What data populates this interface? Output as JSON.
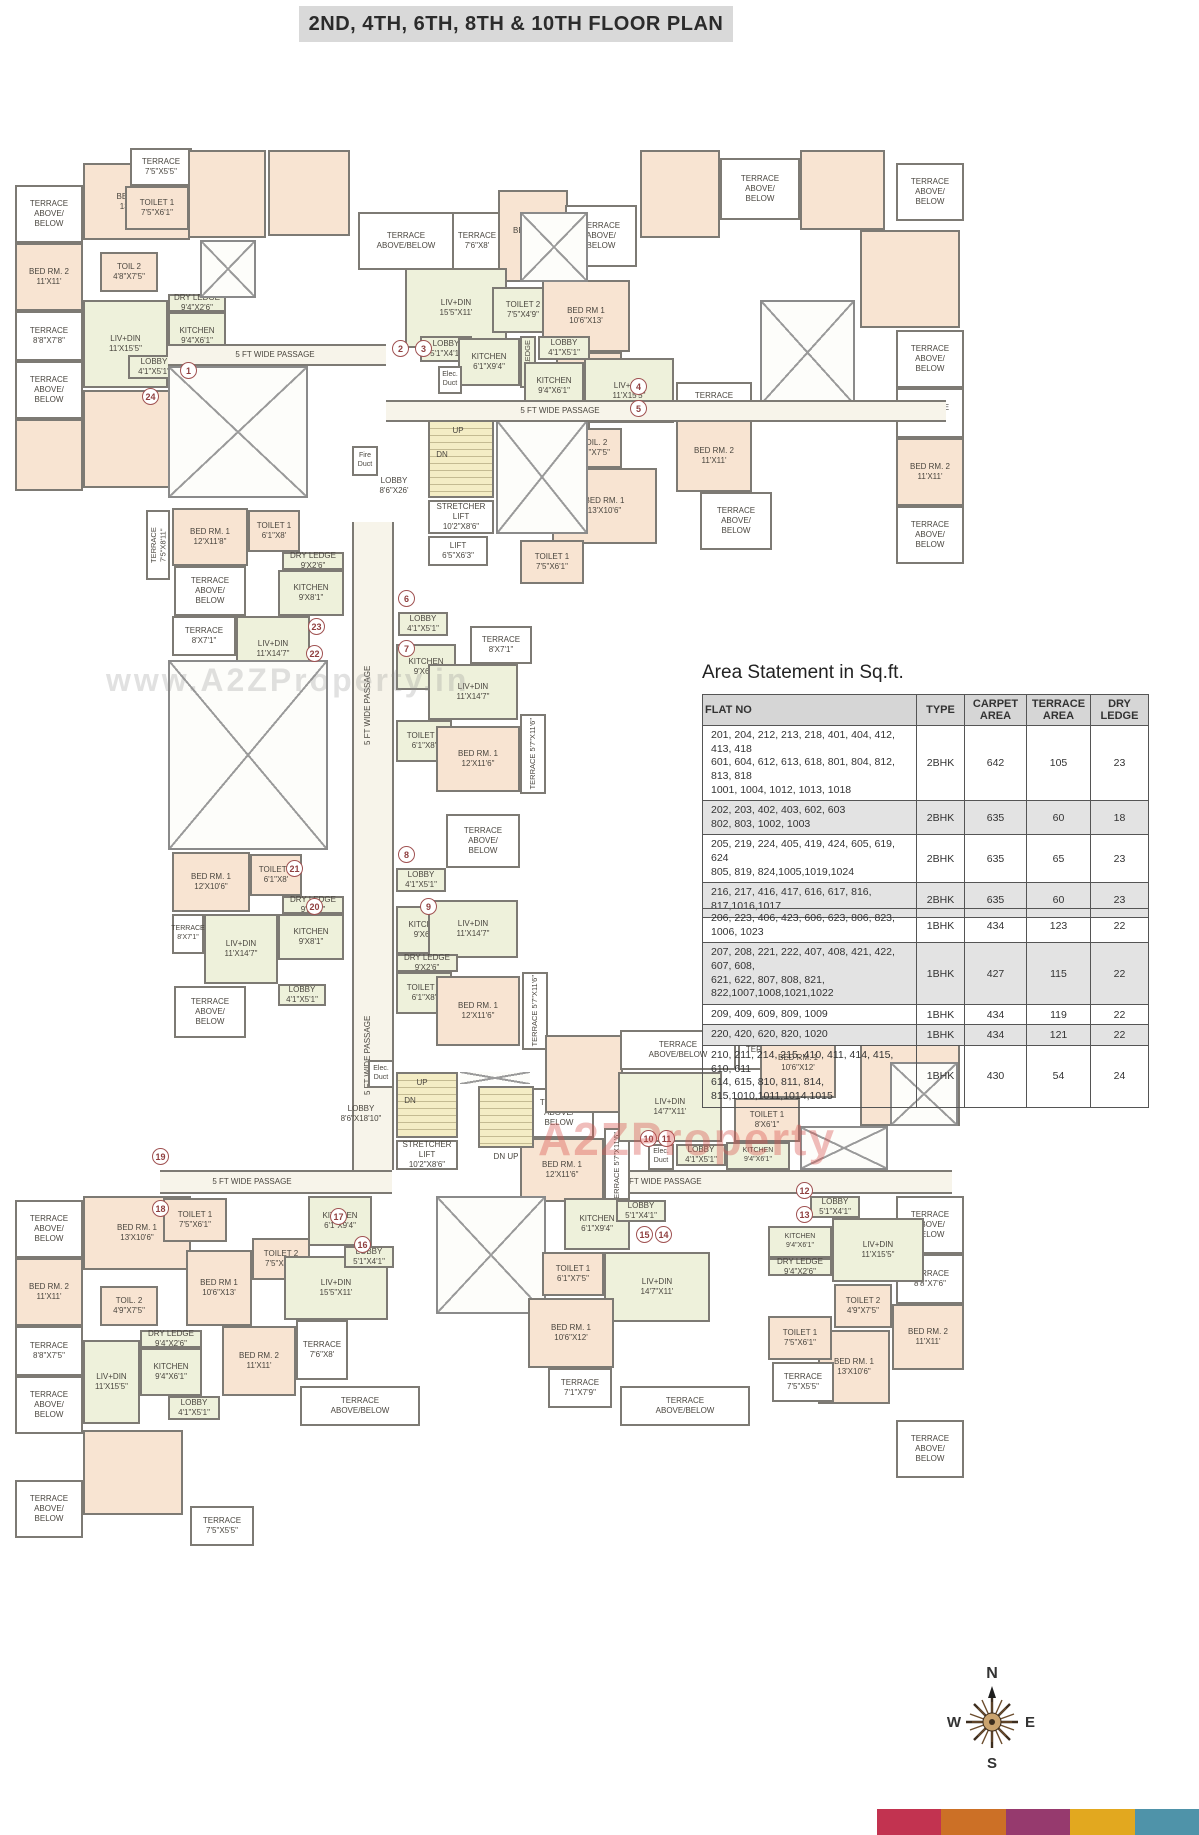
{
  "title": "2ND, 4TH, 6TH, 8TH & 10TH FLOOR PLAN",
  "watermarks": {
    "gray": "www.A2ZProperty.in",
    "red": "A2ZProperty"
  },
  "compass": {
    "n": "N",
    "e": "E",
    "s": "S",
    "w": "W"
  },
  "labels": {
    "tab3": "TERRACE\nABOVE/\nBELOW",
    "tab2": "TERRACE\nABOVE/BELOW",
    "terrace_word": "TERRACE",
    "terr_75x55": "TERRACE\n7'5\"X5'5\"",
    "terr_76x8": "TERRACE\n7'6\"X8'",
    "terr_88x78": "TERRACE\n8'8\"X7'8\"",
    "terr_88x75": "TERRACE\n8'8\"X7'5\"",
    "terr_88x76": "TERRACE\n8'8\"X7'6\"",
    "terr_8x71": "TERRACE\n8'X7'1\"",
    "terr_71x79": "TERRACE\n7'1\"X7'9\"",
    "terr_57x116": "TERRACE 5'7\"X11'6\"",
    "terr_75x811": "TERRACE 7'5\"X8'11\"",
    "bed1_13x106": "BED RM. 1\n13'X10'6\"",
    "bed1_106x13": "BED RM 1\n10'6\"X13'",
    "bed1_12x118": "BED RM. 1\n12'X11'8\"",
    "bed1_12x116": "BED RM. 1\n12'X11'6\"",
    "bed1_12x106": "BED RM. 1\n12'X10'6\"",
    "bed1_106x12": "BED RM. 1\n10'6\"X12'",
    "bed2_11x11": "BED RM. 2\n11'X11'",
    "toilet1_75x61": "TOILET 1\n7'5\"X6'1\"",
    "toilet1_61x8": "TOILET 1\n6'1\"X8'",
    "toilet1_61x75": "TOILET 1\n6'1\"X7'5\"",
    "toilet1_8x61": "TOILET 1\n8'X6'1\"",
    "toilet2_75x49": "TOILET 2\n7'5\"X4'9\"",
    "toilet2_49x75": "TOILET 2\n4'9\"X7'5\"",
    "toil2_48x75": "TOIL 2\n4'8\"X7'5\"",
    "toil2_49x75": "TOIL. 2\n4'9\"X7'5\"",
    "kitchen_94x61": "KITCHEN\n9'4\"X6'1\"",
    "kitchen_61x94": "KITCHEN\n6'1\"X9'4\"",
    "kitchen_9x61": "KITCHEN\n9'X6'1\"",
    "kitchen_9x81": "KITCHEN\n9'X8'1\"",
    "livdin_11x155": "LIV+DIN\n11'X15'5\"",
    "livdin_155x11": "LIV+DIN\n15'5\"X11'",
    "livdin_11x147": "LIV+DIN\n11'X14'7\"",
    "livdin_147x11": "LIV+DIN\n14'7\"X11'",
    "dryledge_94x26": "DRY LEDGE\n9'4\"X2'6\"",
    "dryledge_9x26": "DRY LEDGE\n9'X2'6\"",
    "dryledge_word": "DRY LEDGE",
    "lobby_41x51": "LOBBY\n4'1\"X5'1\"",
    "lobby_51x41": "LOBBY\n5'1\"X4'1\"",
    "lobby_86x26": "LOBBY\n8'6\"X26'",
    "lobby_86x1810": "LOBBY\n8'6\"X18'10\"",
    "stretcher": "STRETCHER LIFT\n10'2\"X8'6\"",
    "lift": "LIFT\n6'5\"X6'3\"",
    "fire_duct": "Fire\nDuct",
    "elec_duct": "Elec.\nDuct",
    "passage": "5 FT WIDE PASSAGE",
    "up": "UP",
    "dn": "DN",
    "dnup": "DN    UP"
  },
  "units": {
    "u1": "1",
    "u2": "2",
    "u3": "3",
    "u4": "4",
    "u5": "5",
    "u6": "6",
    "u7": "7",
    "u8": "8",
    "u9": "9",
    "u10": "10",
    "u11": "11",
    "u12": "12",
    "u13": "13",
    "u14": "14",
    "u15": "15",
    "u16": "16",
    "u17": "17",
    "u18": "18",
    "u19": "19",
    "u20": "20",
    "u21": "21",
    "u22": "22",
    "u23": "23",
    "u24": "24"
  },
  "area_statement": {
    "title": "Area Statement in Sq.ft.",
    "cols": {
      "c1": "FLAT NO",
      "c2": "TYPE",
      "c3": "CARPET\nAREA",
      "c4": "TERRACE\nAREA",
      "c5": "DRY\nLEDGE"
    },
    "t1": [
      {
        "f": "201, 204, 212, 213, 218, 401, 404, 412, 413, 418\n601, 604, 612, 613, 618, 801, 804, 812, 813, 818\n1001, 1004, 1012, 1013, 1018",
        "t": "2BHK",
        "c": "642",
        "a": "105",
        "d": "23"
      },
      {
        "f": "202, 203, 402, 403, 602, 603\n802, 803, 1002, 1003",
        "t": "2BHK",
        "c": "635",
        "a": "60",
        "d": "18"
      },
      {
        "f": "205, 219, 224, 405, 419, 424, 605, 619, 624\n805, 819, 824,1005,1019,1024",
        "t": "2BHK",
        "c": "635",
        "a": "65",
        "d": "23"
      },
      {
        "f": "216, 217, 416, 417, 616, 617, 816, 817,1016,1017",
        "t": "2BHK",
        "c": "635",
        "a": "60",
        "d": "23"
      }
    ],
    "t2": [
      {
        "f": "206, 223, 406, 423, 606, 623, 806, 823, 1006, 1023",
        "t": "1BHK",
        "c": "434",
        "a": "123",
        "d": "22"
      },
      {
        "f": "207, 208, 221, 222, 407, 408, 421, 422, 607, 608,\n621, 622, 807, 808, 821, 822,1007,1008,1021,1022",
        "t": "1BHK",
        "c": "427",
        "a": "115",
        "d": "22"
      },
      {
        "f": "209, 409, 609, 809, 1009",
        "t": "1BHK",
        "c": "434",
        "a": "119",
        "d": "22"
      },
      {
        "f": "220, 420, 620, 820, 1020",
        "t": "1BHK",
        "c": "434",
        "a": "121",
        "d": "22"
      },
      {
        "f": "210, 211, 214, 215, 410, 411, 414, 415, 610, 611\n614, 615, 810, 811, 814, 815,1010,1011,1014,1015",
        "t": "1BHK",
        "c": "430",
        "a": "54",
        "d": "24"
      }
    ]
  },
  "brand_colors": [
    "#c23350",
    "#cc7026",
    "#963a6e",
    "#e2a81f",
    "#4f93a9"
  ]
}
